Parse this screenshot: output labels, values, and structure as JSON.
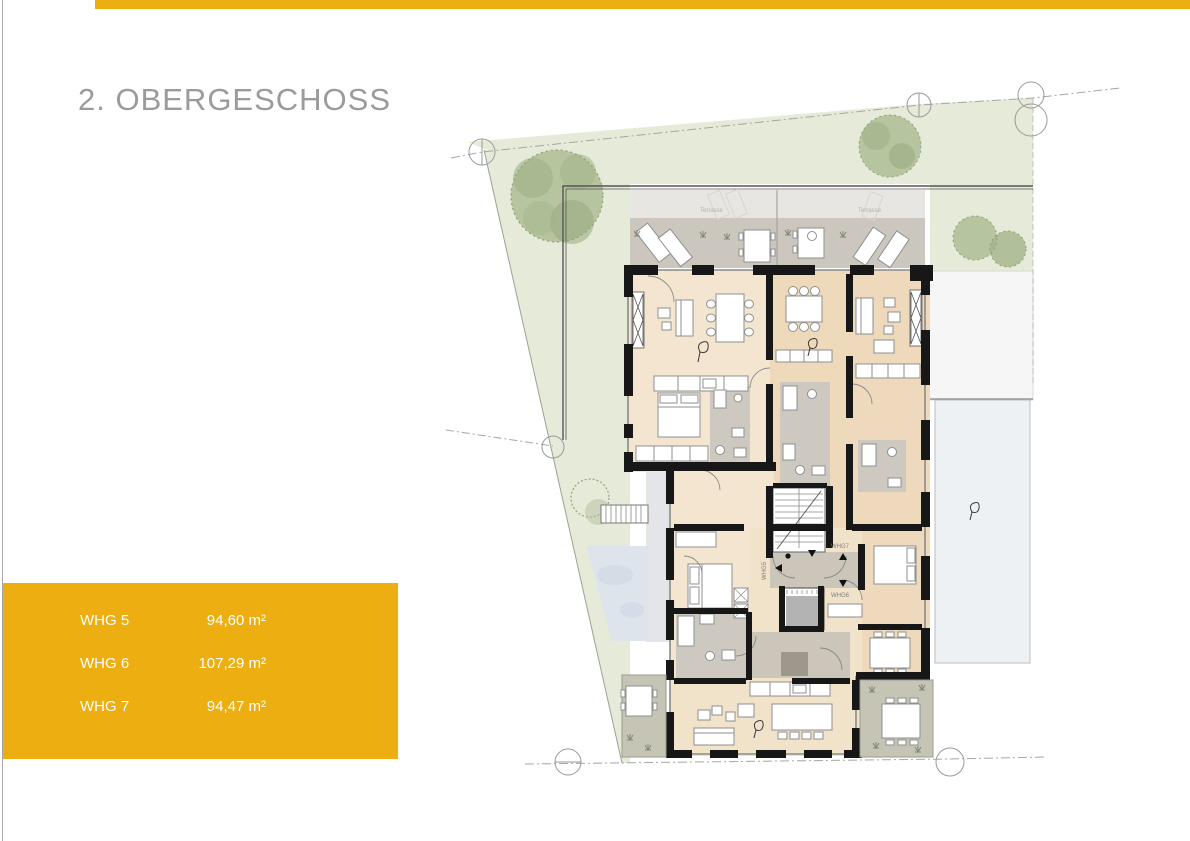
{
  "header": {
    "title": "2. OBERGESCHOSS"
  },
  "legend": {
    "rows": [
      {
        "label": "WHG 5",
        "area": "94,60 m²"
      },
      {
        "label": "WHG 6",
        "area": "107,29 m²"
      },
      {
        "label": "WHG 7",
        "area": "94,47 m²"
      }
    ]
  },
  "plan": {
    "labels": {
      "whg5": "WHG5",
      "whg6": "WHG6",
      "whg7": "WHG7",
      "terrasse_left": "Terrasse",
      "terrasse_right": "Terrasse"
    }
  },
  "colors": {
    "accent_gold": "#ECAE10",
    "lawn_green": "#e5ebd8",
    "tree_green": "#aebd97",
    "terrace_light": "#e8e6e3",
    "terrace_dark": "#cbc7be",
    "terrace_garden": "#c6c5b5",
    "room_beige_light": "#f3e5cf",
    "room_beige_warm": "#eedaba",
    "wetroom_gray": "#cdc9c0",
    "hall_gray": "#cbc5ba",
    "wall_black": "#171717",
    "pond_blue": "#dde4ec",
    "roof_terrace_blue": "#edf1f4",
    "title_gray": "#9b9b9b"
  }
}
